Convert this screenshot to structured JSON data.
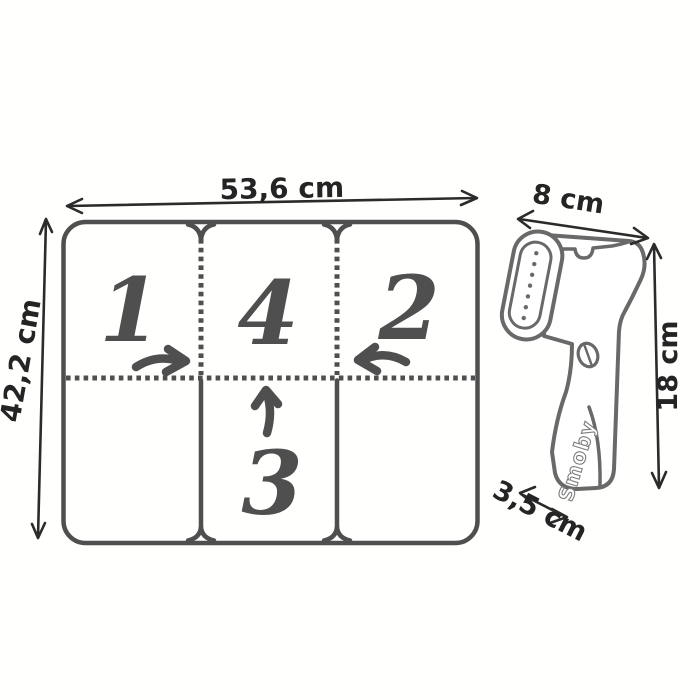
{
  "board": {
    "width_label": "53,6 cm",
    "height_label": "42,2 cm",
    "sections": {
      "top_left": "1",
      "top_center": "4",
      "top_right": "2",
      "bottom_center": "3"
    }
  },
  "steamer": {
    "width_label": "8 cm",
    "height_label": "18 cm",
    "depth_label": "3,5 cm",
    "brand": "Smoby"
  },
  "colors": {
    "background": "#ffffff",
    "board_line": "#4f4f4f",
    "dimension_line": "#2b2b2b",
    "label_text": "#242424",
    "steamer_line": "#696969"
  }
}
